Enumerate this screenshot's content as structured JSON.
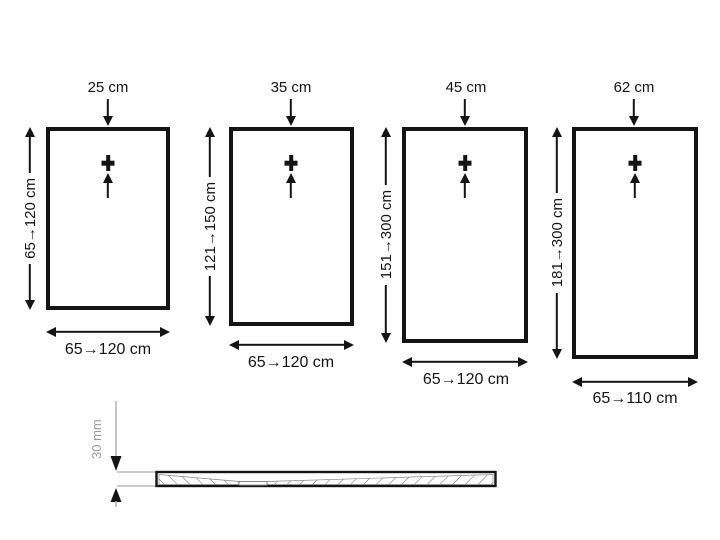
{
  "panels": [
    {
      "drain_offset": "25 cm",
      "length_range": "65→120 cm",
      "width_range": "65→120 cm"
    },
    {
      "drain_offset": "35 cm",
      "length_range": "121→150 cm",
      "width_range": "65→120 cm"
    },
    {
      "drain_offset": "45 cm",
      "length_range": "151→300 cm",
      "width_range": "65→120 cm"
    },
    {
      "drain_offset": "62 cm",
      "length_range": "181→300 cm",
      "width_range": "65→110 cm"
    }
  ],
  "cross_section": {
    "thickness": "30 mm"
  },
  "colors": {
    "line": "#141414",
    "dim_gray": "#9a9a9a",
    "hatch": "#666666",
    "background": "#ffffff"
  }
}
